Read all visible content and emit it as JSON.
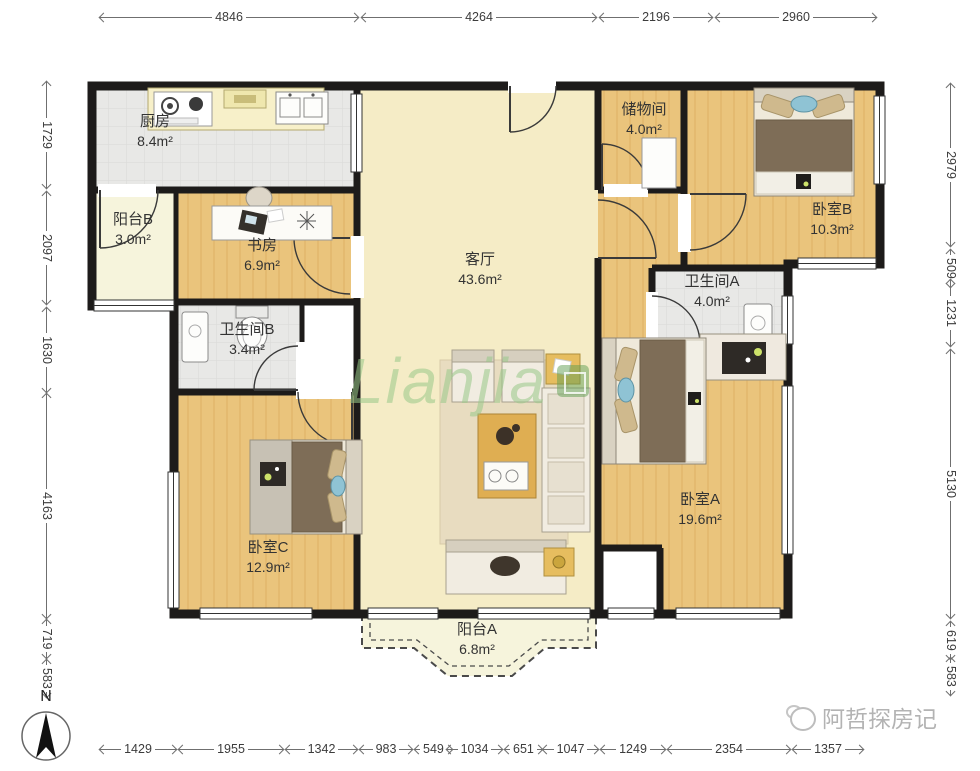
{
  "rooms": {
    "kitchen": {
      "name": "厨房",
      "area": "8.4m²"
    },
    "balcony_b": {
      "name": "阳台B",
      "area": "3.0m²"
    },
    "study": {
      "name": "书房",
      "area": "6.9m²"
    },
    "bath_b": {
      "name": "卫生间B",
      "area": "3.4m²"
    },
    "living": {
      "name": "客厅",
      "area": "43.6m²"
    },
    "storage": {
      "name": "储物间",
      "area": "4.0m²"
    },
    "bed_b": {
      "name": "卧室B",
      "area": "10.3m²"
    },
    "bath_a": {
      "name": "卫生间A",
      "area": "4.0m²"
    },
    "bed_a": {
      "name": "卧室A",
      "area": "19.6m²"
    },
    "bed_c": {
      "name": "卧室C",
      "area": "12.9m²"
    },
    "balcony_a": {
      "name": "阳台A",
      "area": "6.8m²"
    }
  },
  "dimensions": {
    "top": [
      "4846",
      "4264",
      "2196",
      "2960"
    ],
    "left": [
      "1729",
      "2097",
      "1630",
      "4163",
      "719",
      "583"
    ],
    "right": [
      "2979",
      "509",
      "1231",
      "5130",
      "619",
      "583"
    ],
    "bottom": [
      "1429",
      "1955",
      "1342",
      "983",
      "549",
      "1034",
      "651",
      "1047",
      "1249",
      "2354",
      "1357"
    ]
  },
  "watermark": {
    "brand": "Lianjia",
    "publisher": "阿哲探房记"
  },
  "compass": {
    "label": "N"
  },
  "colors": {
    "wall": "#1d1b1a",
    "wood": "#eac47c",
    "living_floor": "#f5ecc6",
    "tile": "#e8e8e6",
    "balcony_floor": "#f6f4dc",
    "accent_green": "#98c888"
  }
}
